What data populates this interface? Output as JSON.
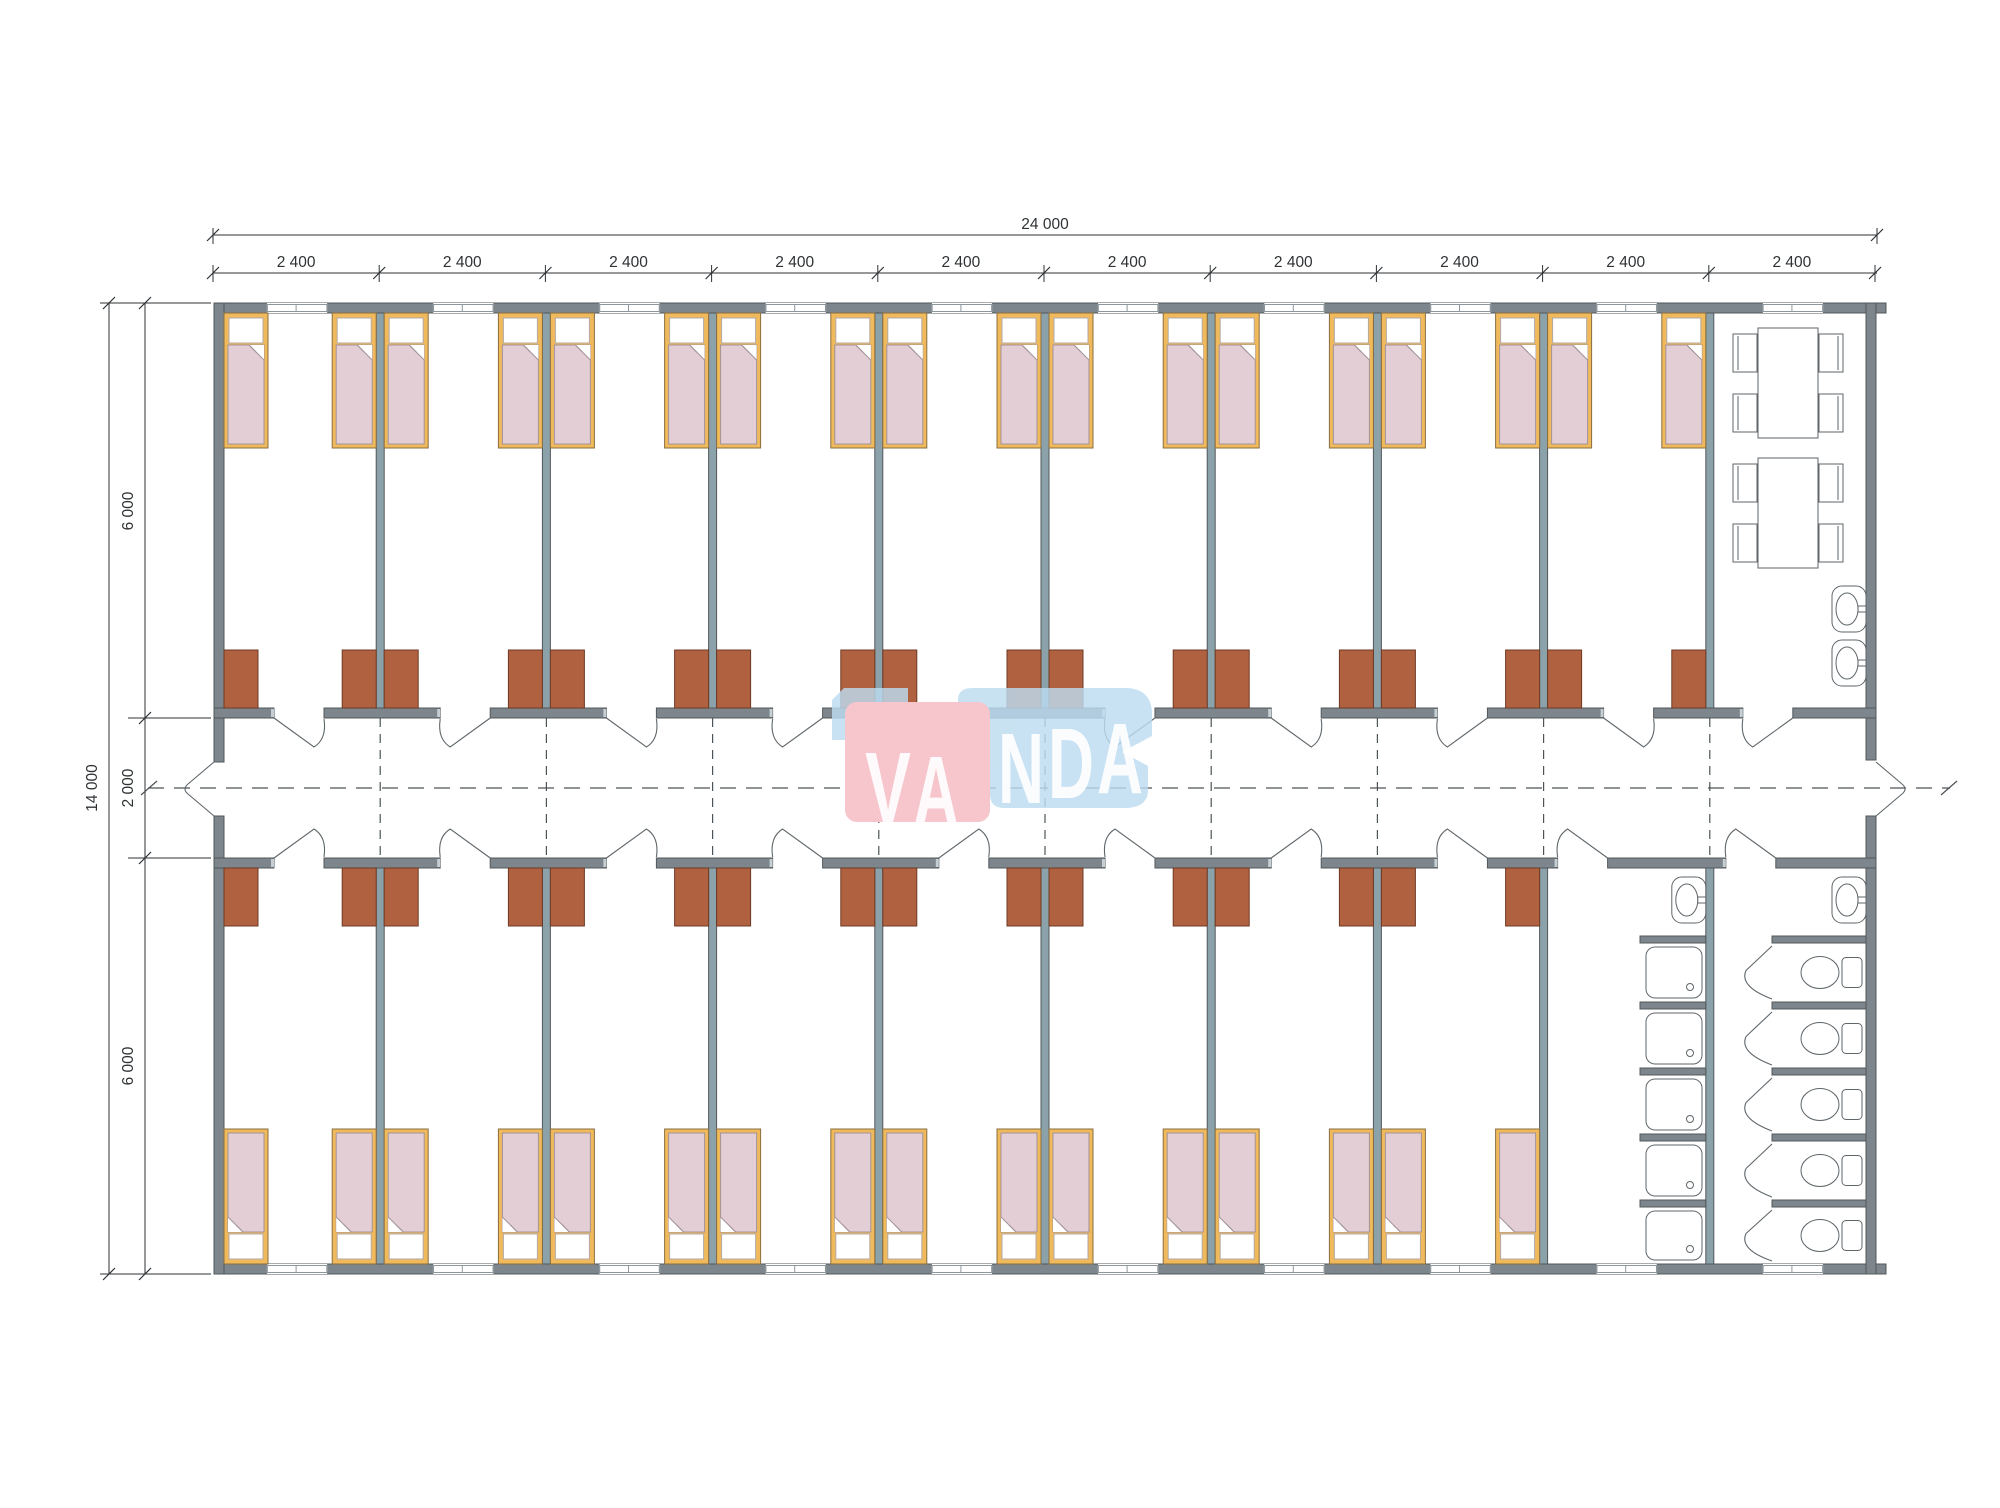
{
  "watermark": {
    "text": "VANDA",
    "pink_color": "#f6c6cc",
    "blue_color": "#bcdcf0",
    "text_color": "#ffffff"
  },
  "dimensions": {
    "top_total": "24 000",
    "top_segments": [
      "2 400",
      "2 400",
      "2 400",
      "2 400",
      "2 400",
      "2 400",
      "2 400",
      "2 400",
      "2 400",
      "2 400"
    ],
    "left_total": "14 000",
    "left_segments": [
      "6 000",
      "2 000",
      "6 000"
    ]
  },
  "plan": {
    "building": {
      "width_mm": 24000,
      "depth_mm": 14000,
      "modules": 10,
      "module_width_mm": 2400
    },
    "corridor": {
      "depth_mm": 2000
    },
    "rooms": {
      "bedrooms_top": 9,
      "bedrooms_bottom": 8,
      "beds_per_room": 2,
      "wardrobes_per_room": 2,
      "dining": {
        "tables": 2,
        "chairs_per_table": 4,
        "sinks": 2
      },
      "shower_room": {
        "showers": 5,
        "sinks": 1
      },
      "toilet_room": {
        "toilets": 5,
        "sinks": 1
      }
    },
    "totals": {
      "beds": 34,
      "wardrobes": 34,
      "sinks": 4,
      "showers": 5,
      "toilets": 5
    },
    "colors": {
      "wall": "#7d868c",
      "wall_stroke": "#53585b",
      "inner_wall": "#8ba2ab",
      "jamb": "#c6d0d4",
      "window_line": "#8e979c",
      "bed_frame": "#f0b95b",
      "bed_frame_stroke": "#8a6f42",
      "blanket": "#e4ced6",
      "blanket_stroke": "#a29399",
      "pillow": "#ffffff",
      "wardrobe": "#b06140",
      "wardrobe_stroke": "#6e3a24",
      "fixture": "#5f666a",
      "door": "#5f666a",
      "dash": "#4d5356",
      "dim": "#2e3234"
    }
  }
}
